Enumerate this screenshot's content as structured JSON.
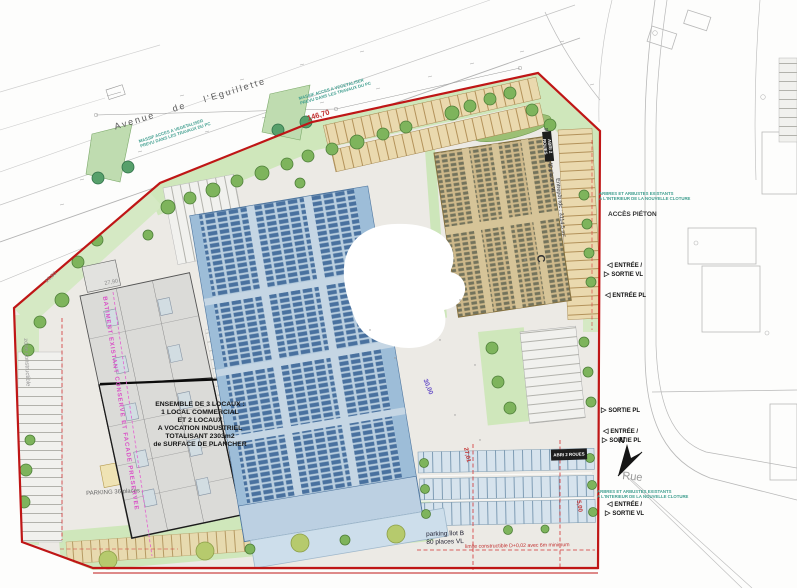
{
  "colors": {
    "boundary_red": "#bf1616",
    "green_area": "#cfe7bb",
    "tree_green": "#7eb45c",
    "building_a_gray": "#dbdbd8",
    "building_b_blue": "#b9cedf",
    "solar_panel_blue": "#49719f",
    "building_c_tan": "#cdb88a",
    "panel_olive": "#73735c",
    "annotation_pink": "#d94fc6",
    "annotation_teal": "#3f9e8f",
    "dim_red": "#c23030",
    "dim_purple": "#6a52c8"
  },
  "streets": {
    "avenue": "Avenue de l'Eguillette",
    "rue": "Rue"
  },
  "compass": {
    "north": "N"
  },
  "annotations": {
    "massif": {
      "l1": "MASSIF ACCES A VEGETALISER",
      "l2": "PREVU DANS LES TRAVAUX DU PC"
    },
    "arbres": {
      "l1": "ARBRES ET ARBUSTES EXISTANTS",
      "l2": "A L'INTERIEUR DE LA NOUVELLE CLOTURE"
    },
    "acces_pieton": "ACCÈS PIÉTON",
    "batiment_existant": "BATIMENT EXISTANT CONSERVE ET FACADE PRESERVEE",
    "zone_constructible": "zone constructible",
    "limite": "limite constructible D+0,02 avec 6m minimum",
    "abri": "ABRI 2 ROUES"
  },
  "building_a": {
    "lines": [
      "ENSEMBLE DE 3 LOCAUX :",
      "1 LOCAL COMMERCIAL",
      "ET 2 LOCAUX",
      "A VOCATION INDUSTRIEL",
      "TOTALISANT 2303m2",
      "de SURFACE DE PLANCHER"
    ],
    "parking": "PARKING 36 places"
  },
  "building_c": {
    "label": "C",
    "note": "Entrepôt rdc : 3114,5 m²",
    "parking": "parking îlot C 40 places VL"
  },
  "parking_b": {
    "l1": "parking îlot B",
    "l2": "80 places VL"
  },
  "access": {
    "items": [
      {
        "glyph": "◁",
        "label": "ENTRÉE /"
      },
      {
        "glyph": "▷",
        "label": "SORTIE VL"
      },
      {
        "glyph": "◁",
        "label": "ENTRÉE PL"
      },
      {
        "glyph": "▷",
        "label": "SORTIE PL"
      },
      {
        "glyph": "◁",
        "label": "ENTRÉE /"
      },
      {
        "glyph": "▷",
        "label": "SORTIE PL"
      },
      {
        "glyph": "◁",
        "label": "ENTRÉE /"
      },
      {
        "glyph": "▷",
        "label": "SORTIE VL"
      }
    ]
  },
  "dims": {
    "top": "146,70",
    "d1650": "16,50",
    "d2790": "27,90",
    "court": "30,00",
    "pk": "27,01",
    "p500": "5,00"
  }
}
